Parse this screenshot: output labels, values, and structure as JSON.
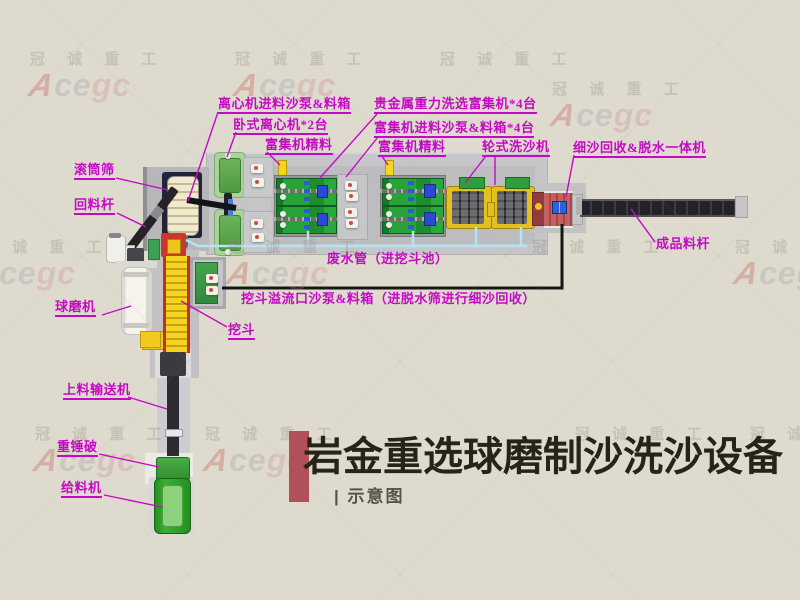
{
  "watermark": {
    "company": "冠 诚 重 工",
    "brand_a": "A",
    "brand_mid": "ce",
    "brand_end": "gc"
  },
  "title": {
    "text": "岩金重选球磨制沙洗沙设备",
    "subtitle": "| 示意图"
  },
  "labels": {
    "centrifuge_feed_pump": "离心机进料沙泵&料箱",
    "horizontal_centrifuge": "卧式离心机*2台",
    "concentrate_left": "富集机精料",
    "gravity_concentrator": "贵金属重力洗选富集机*4台",
    "concentrator_feed_pump": "富集机进料沙泵&料箱*4台",
    "concentrate_right": "富集机精料",
    "wheel_washer": "轮式洗沙机",
    "fine_sand_recovery": "细沙回收&脱水一体机",
    "drum_screen": "滚筒筛",
    "return_rod": "回料杆",
    "ball_mill": "球磨机",
    "bucket": "挖斗",
    "waste_pipe": "废水管（进挖斗池）",
    "overflow_pump": "挖斗溢流口沙泵&料箱（进脱水筛进行细沙回收）",
    "product_rod": "成品料杆",
    "feeding_conveyor": "上料输送机",
    "hammer_crusher": "重锤破",
    "feeder": "给料机"
  },
  "colors": {
    "label": "#c50ac5",
    "accent_bar": "#b2505a",
    "waste_pipe": "#b5e3f4",
    "title": "#282318"
  }
}
